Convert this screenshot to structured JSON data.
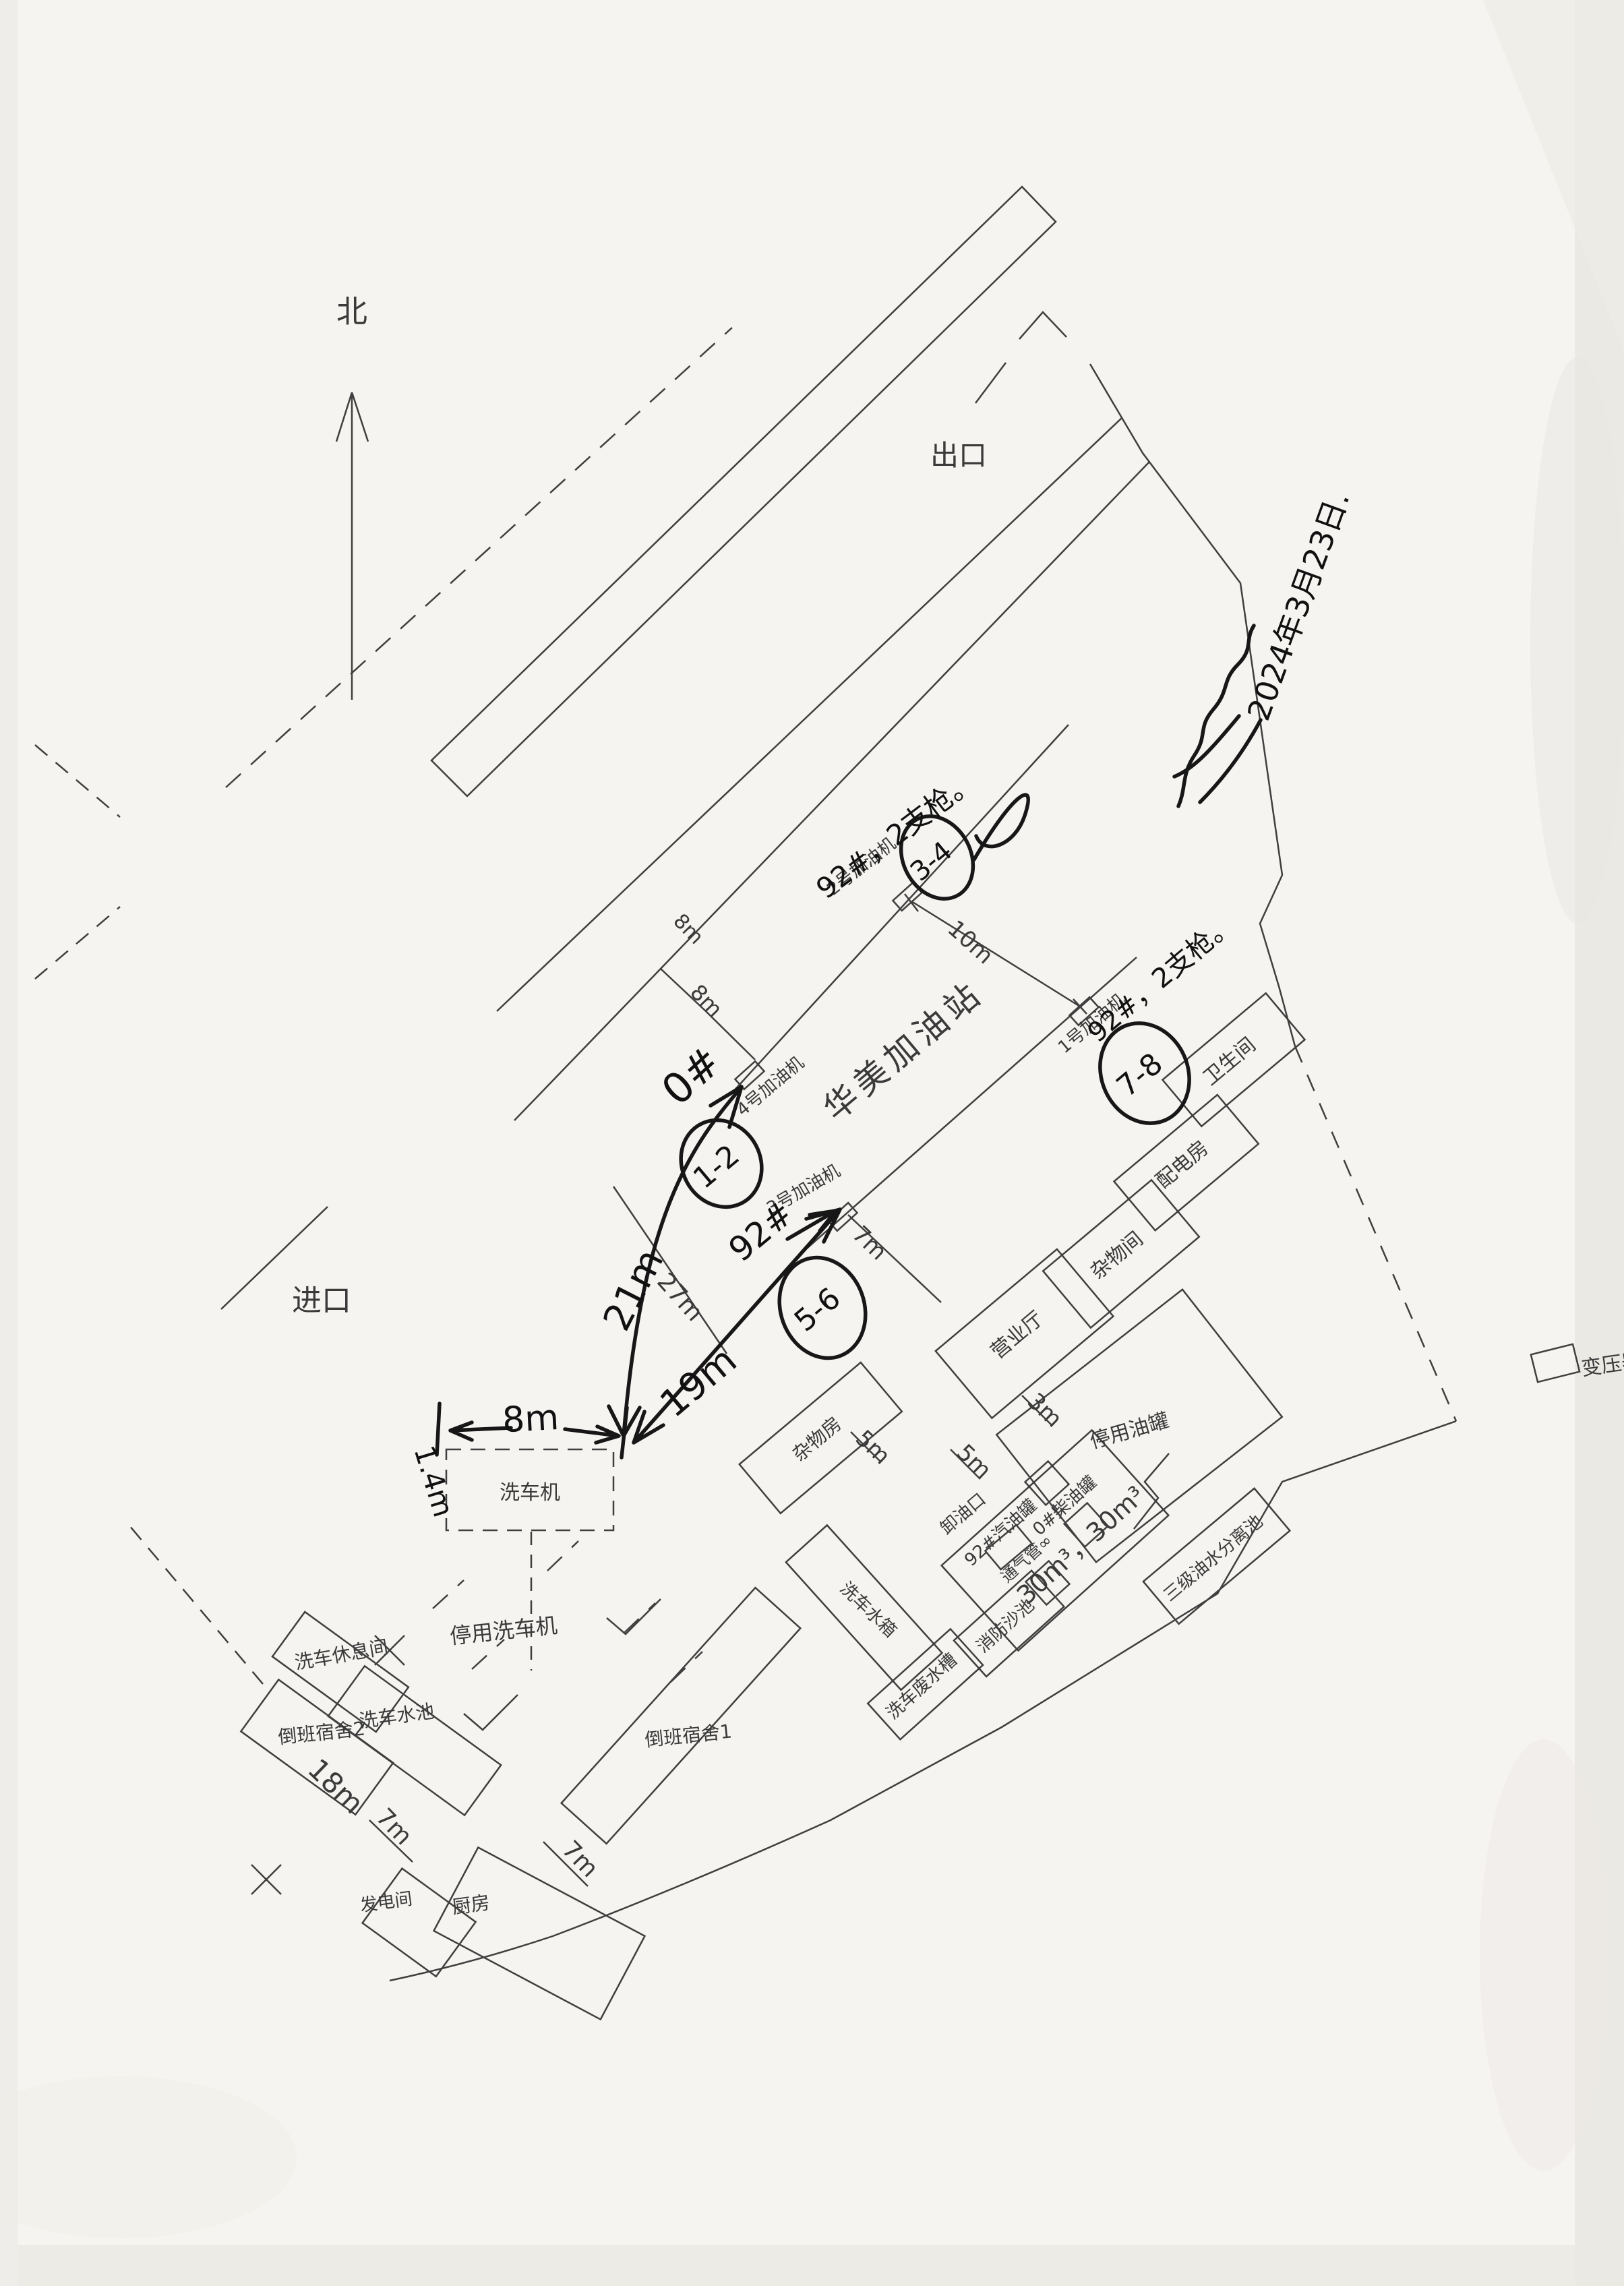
{
  "compass": {
    "north": "北"
  },
  "access": {
    "exit": "出口",
    "entrance": "进口"
  },
  "station": {
    "name": "华美加油站"
  },
  "meta": {
    "date": "2024年3月23日."
  },
  "dispensers": {
    "d1": "1号加油机",
    "d2": "2号加油机",
    "d3": "3号加油机",
    "d4": "4号加油机"
  },
  "notes": {
    "d1_note": "92#，2支枪。",
    "d2_note": "92#，2支枪。",
    "d3_grade": "92#",
    "d4_grade": "0#"
  },
  "nozzles": {
    "g12": "1-2",
    "g34": "3-4",
    "g56": "5-6",
    "g78": "7-8"
  },
  "hand_dims": {
    "width8": "8m",
    "depth14": "1.4m",
    "run21": "21m",
    "run19": "19m"
  },
  "buildings": {
    "toilet": "卫生间",
    "power_room": "配电房",
    "sundry_room": "杂物间",
    "business_hall": "营业厅",
    "sundry_house": "杂物房",
    "disused_tanks": "停用油罐",
    "unload_port": "卸油口",
    "fire_sand": "消防沙池",
    "wash_waste": "洗车废水槽",
    "separator": "三级油水分离池",
    "transformer": "变压器",
    "car_washer": "洗车机",
    "disused_washer": "停用洗车机",
    "wash_rest": "洗车休息间",
    "wash_pool": "洗车水池",
    "dorm2": "倒班宿舍2",
    "dorm1": "倒班宿舍1",
    "wash_tank": "洗车水箱",
    "generator": "发电间",
    "kitchen": "厨房"
  },
  "tanks": {
    "gasoline": "92#汽油罐",
    "vent": "通气管∞",
    "diesel": "0#柴油罐",
    "volume": "30m³，30m³"
  },
  "dims": {
    "gap8": "8m",
    "band8": "8m",
    "island10": "10m",
    "island7": "7m",
    "hall3": "3m",
    "sundry5": "5m",
    "unload5": "5m",
    "wash27": "27m",
    "dorm18": "18m",
    "gen7": "7m",
    "kitchen7": "7m"
  }
}
